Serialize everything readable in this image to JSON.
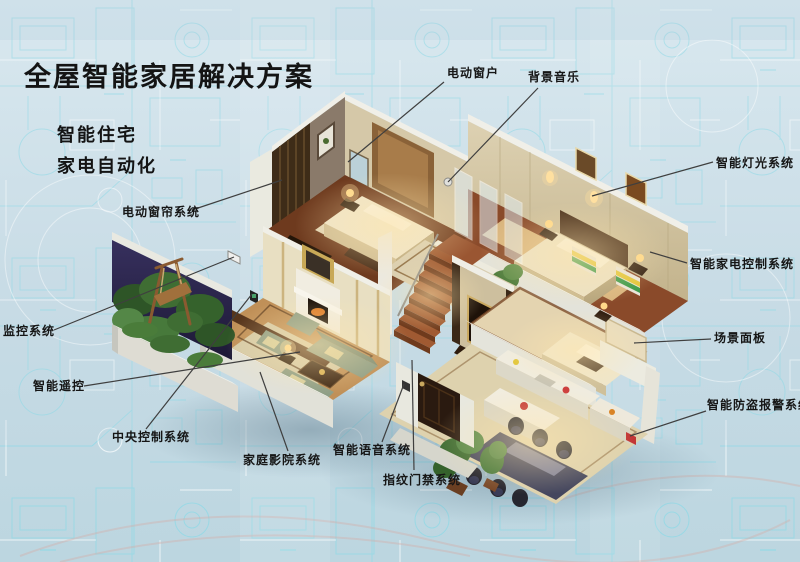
{
  "title": "全屋智能家居解决方案",
  "subtitles": [
    "智能住宅",
    "家电自动化"
  ],
  "labels": [
    {
      "id": "electric-window",
      "text": "电动窗户"
    },
    {
      "id": "background-music",
      "text": "背景音乐"
    },
    {
      "id": "smart-lighting",
      "text": "智能灯光系统"
    },
    {
      "id": "smart-appliance-control",
      "text": "智能家电控制系统"
    },
    {
      "id": "scene-panel",
      "text": "场景面板"
    },
    {
      "id": "anti-theft-alarm",
      "text": "智能防盗报警系统"
    },
    {
      "id": "electric-curtain",
      "text": "电动窗帘系统"
    },
    {
      "id": "monitoring-system",
      "text": "监控系统"
    },
    {
      "id": "smart-remote",
      "text": "智能遥控"
    },
    {
      "id": "central-control",
      "text": "中央控制系统"
    },
    {
      "id": "home-theater",
      "text": "家庭影院系统"
    },
    {
      "id": "smart-voice",
      "text": "智能语音系统"
    },
    {
      "id": "fingerprint-access",
      "text": "指纹门禁系统"
    }
  ],
  "colors": {
    "background": "#cadde7",
    "blueprint_line": "#8fd9e6",
    "text": "#141414",
    "leader_line": "#3f3f3f",
    "wall": "#e8e8df",
    "wood_floor": "#7a4022",
    "sofa_green": "#8e9e86",
    "bed_linen": "#efe5c9"
  },
  "illustration": {
    "type": "isometric-cutaway-smart-home",
    "background_style": "blueprint schematic"
  }
}
